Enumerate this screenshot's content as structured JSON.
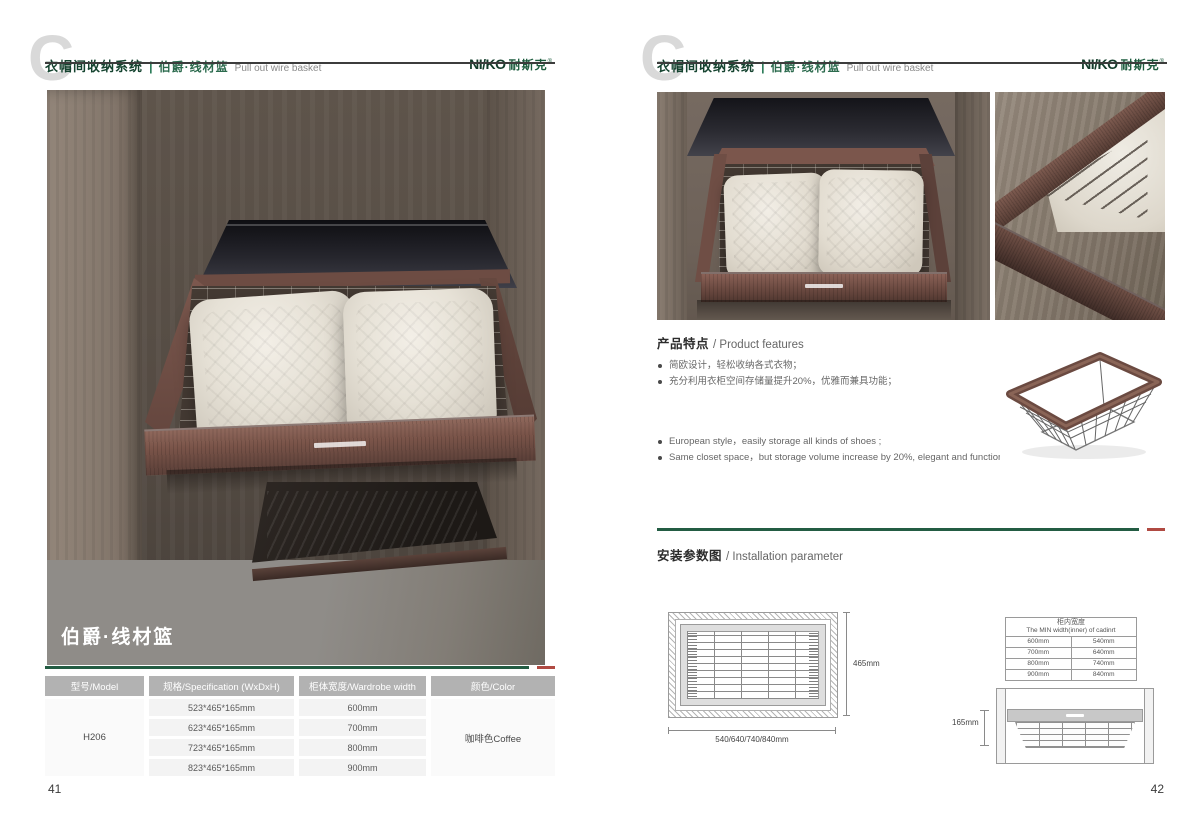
{
  "brand": {
    "watermark": "C",
    "header_title_cn": "衣帽间收纳系统",
    "header_divider": "|",
    "header_sub_cn": "伯爵·线材篮",
    "header_sub_en": "Pull out wire basket",
    "logo_en": "NI/KO",
    "logo_cn": "耐斯克",
    "logo_reg": "®",
    "colors": {
      "brand_green": "#235c43",
      "accent_red": "#b04a42"
    }
  },
  "left_page": {
    "page_number": "41",
    "photo_caption": "伯爵·线材篮",
    "table": {
      "headers": [
        "型号/Model",
        "规格/Specification (WxDxH)",
        "柜体宽度/Wardrobe width",
        "颜色/Color"
      ],
      "model": "H206",
      "rows": [
        {
          "spec": "523*465*165mm",
          "width": "600mm"
        },
        {
          "spec": "623*465*165mm",
          "width": "700mm"
        },
        {
          "spec": "723*465*165mm",
          "width": "800mm"
        },
        {
          "spec": "823*465*165mm",
          "width": "900mm"
        }
      ],
      "color": "咖啡色Coffee"
    }
  },
  "right_page": {
    "page_number": "42",
    "features": {
      "title_cn": "产品特点",
      "title_en": "/ Product features",
      "bullets_cn": [
        "简欧设计，轻松收纳各式衣物；",
        "充分利用衣柜空间存储量提升20%，优雅而兼具功能；"
      ],
      "bullets_en": [
        "European style，easily storage all kinds of shoes ;",
        "Same closet space，but storage volume increase by 20%, elegant and functional;"
      ]
    },
    "installation": {
      "title_cn": "安装参数图",
      "title_en": "/ Installation parameter",
      "top_view": {
        "height_label": "465mm",
        "width_label": "540/640/740/840mm"
      },
      "min_width_table": {
        "title_cn": "柜内宽度",
        "title_en": "The MIN width(inner) of cadinrt",
        "rows": [
          [
            "600mm",
            "540mm"
          ],
          [
            "700mm",
            "640mm"
          ],
          [
            "800mm",
            "740mm"
          ],
          [
            "900mm",
            "840mm"
          ]
        ]
      },
      "front_view": {
        "height_label": "165mm"
      }
    }
  }
}
